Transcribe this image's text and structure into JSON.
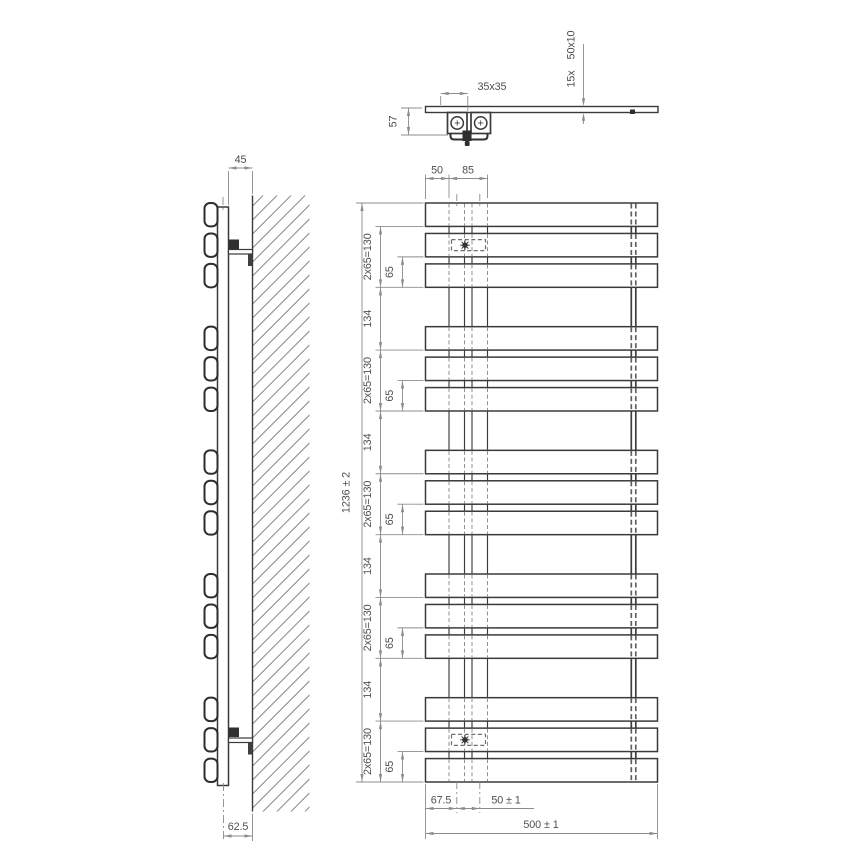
{
  "drawing": {
    "type": "technical-drawing",
    "subject": "flat-tube towel radiator, orthographic views (top, side, front)"
  },
  "top_view": {
    "connector_dim": "35x35",
    "depth_dim": "57",
    "tube_count_label": "15x",
    "tube_profile_label": "50x10"
  },
  "side_view": {
    "wall_distance_dim": "45",
    "mount_depth_dim": "62.5"
  },
  "front_view": {
    "edge_to_collector_dim": "50",
    "collector_span_dim": "85",
    "overall_height_dim": "1236 ± 2",
    "tube_group_dim": "2x65=130",
    "group_gap_dim": "134",
    "tube_pitch_dim": "65",
    "edge_to_pipe_dim": "67.5",
    "pipe_spacing_dim": "50 ± 1",
    "overall_width_dim": "500 ± 1",
    "tube_rows": 15,
    "groups": 5,
    "tubes_per_group": 3
  },
  "colors": {
    "background": "#ffffff",
    "object_line": "#3a3a3a",
    "hidden_line": "#909090",
    "channel_hidden_line": "#606060",
    "channel_solid_line": "#3d3d3d",
    "dim_line": "#8c8c8c",
    "text": "#4f4f4f",
    "bracket_fill": "#2f2f2f",
    "hatch_line": "#8a8a8a"
  }
}
